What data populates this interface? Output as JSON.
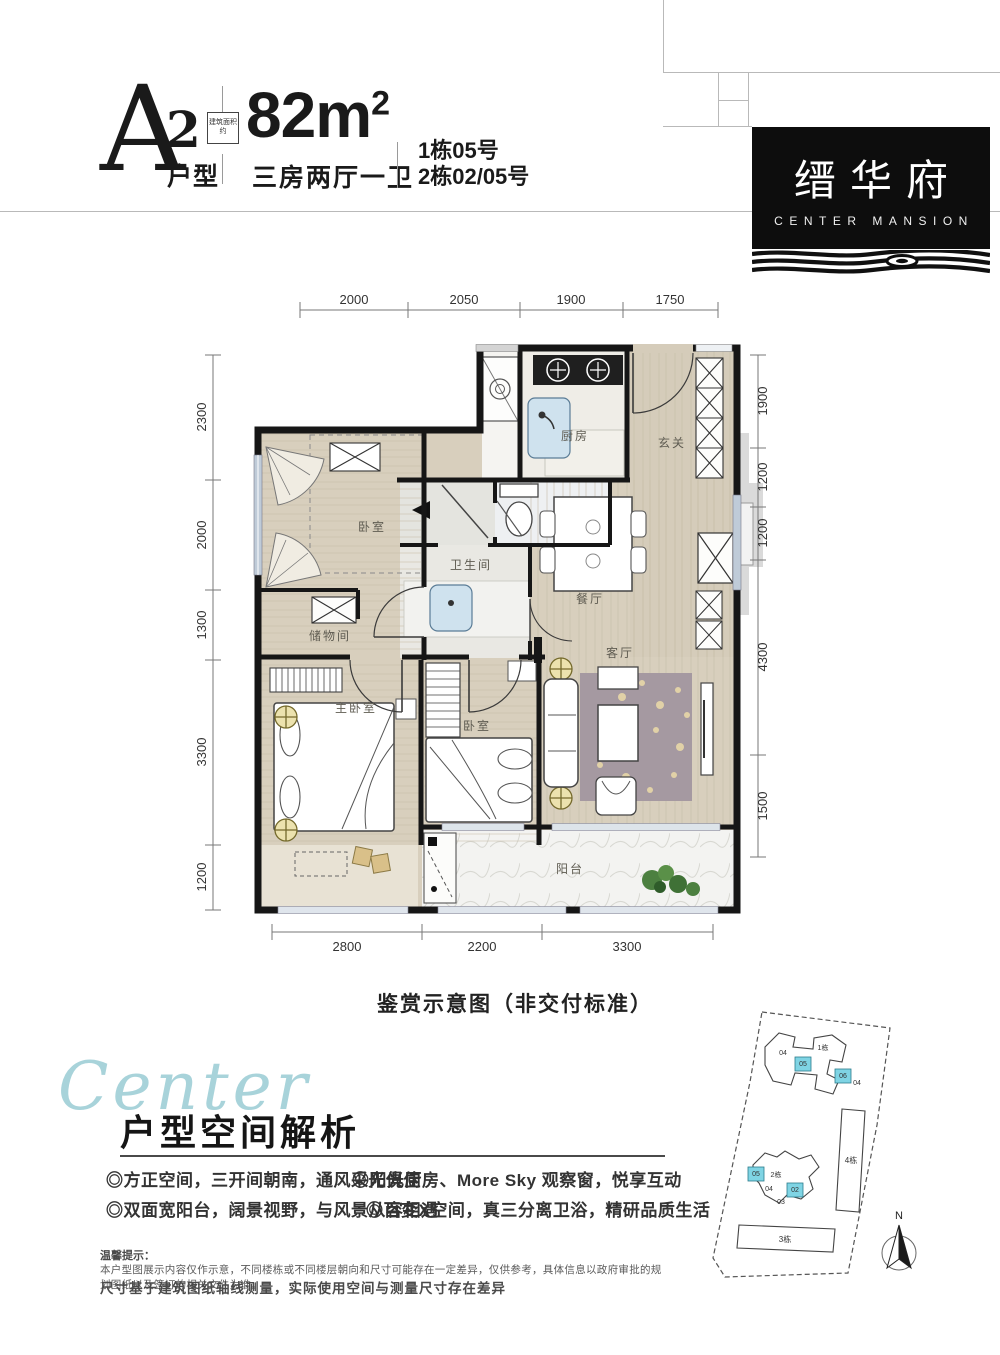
{
  "colors": {
    "accent_cyan": "#7fd4e4",
    "script_blue": "#a8d3da",
    "wall": "#161616",
    "wood": "#d8cfbd",
    "marble": "#f1f0ea",
    "rug": "#a599a1",
    "window": "#bfcbd8"
  },
  "header": {
    "plan_letter": "A",
    "plan_sup": "2",
    "plan_type": "户型",
    "area_badge": "建筑面积约",
    "area_value": "82m",
    "area_sup": "2",
    "layout_text": "三房两厅一卫",
    "unit_line1": "1栋05号",
    "unit_line2": "2栋02/05号"
  },
  "logo": {
    "name_cn": "缙华府",
    "name_en": "CENTER MANSION"
  },
  "floorplan": {
    "caption": "鉴赏示意图（非交付标准）",
    "dims_top": [
      "2000",
      "2050",
      "1900",
      "1750"
    ],
    "dims_left": [
      "2300",
      "2000",
      "1300",
      "3300",
      "1200"
    ],
    "dims_right": [
      "1900",
      "1200",
      "1200",
      "4300",
      "1500"
    ],
    "dims_bottom": [
      "2800",
      "2200",
      "3300"
    ],
    "rooms": {
      "kitchen": "厨房",
      "entry": "玄关",
      "bedroom1": "卧室",
      "bathroom": "卫生间",
      "dining": "餐厅",
      "storage": "储物间",
      "master": "主卧室",
      "bedroom2": "卧室",
      "living": "客厅",
      "balcony": "阳台"
    }
  },
  "analysis": {
    "script_word": "Center",
    "title": "户型空间解析",
    "bullets": [
      "◎方正空间，三开间朝南，通风采光俱佳",
      "◎阳光厨房、More Sky 观察窗，悦享互动",
      "◎双面宽阳台，阔景视野，与风景从容相遇",
      "◎百变X空间，真三分离卫浴，精研品质生活"
    ]
  },
  "disclaimer": {
    "title": "温馨提示：",
    "line1": "本户型图展示内容仅作示意，不同楼栋或不同楼层朝向和尺寸可能存在一定差异，仅供参考，具体信息以政府审批的规划图纸以及签订的相关文件为准。",
    "line2": "尺寸基于建筑图纸轴线测量，实际使用空间与测量尺寸存在差异"
  },
  "siteplan": {
    "north_label": "N",
    "buildings": [
      {
        "label": "1栋"
      },
      {
        "label": "2栋"
      },
      {
        "label": "3栋"
      },
      {
        "label": "4栋"
      }
    ],
    "units": [
      "04",
      "05",
      "06",
      "02",
      "03"
    ]
  }
}
